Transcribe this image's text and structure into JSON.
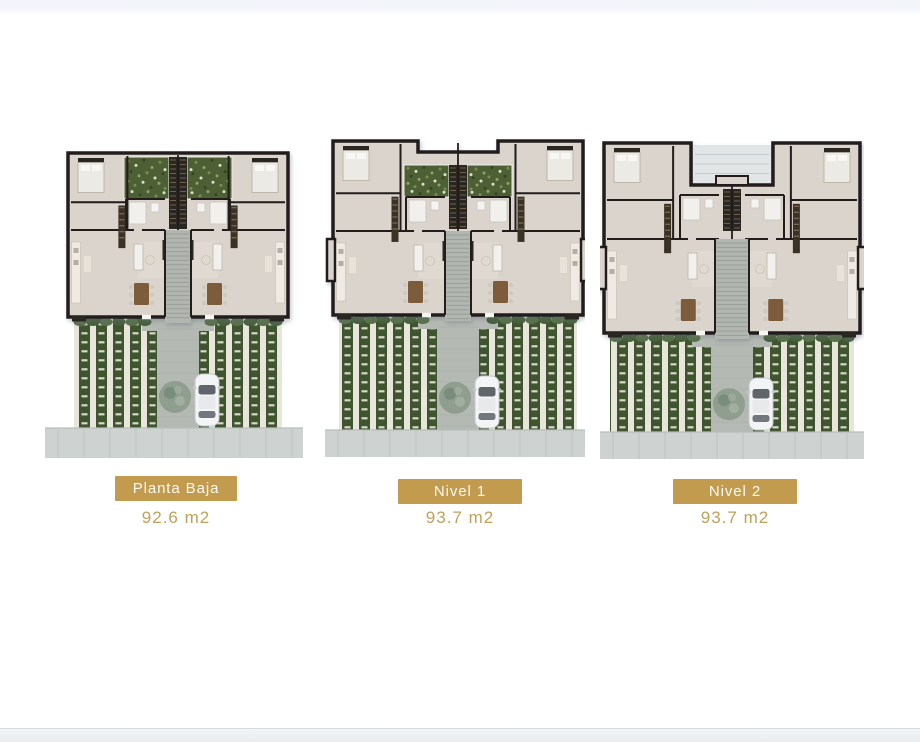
{
  "plans": [
    {
      "name": "Planta Baja",
      "area": "92.6 m2"
    },
    {
      "name": "Nivel 1",
      "area": "93.7 m2"
    },
    {
      "name": "Nivel 2",
      "area": "93.7 m2"
    }
  ],
  "palette": {
    "badge_bg": "#c29b4e",
    "badge_text": "#fdfaf2",
    "area_text": "#c0a159",
    "top_band": "#f4f5fa",
    "bottom_band_light": "#f2f4f6",
    "bottom_band": "#e9edf0",
    "bottom_line": "#d5dade",
    "wall": "#211e1b",
    "floor": "#dbd4cc",
    "floor_light": "#e6e0d9",
    "court_green": "#4d6035",
    "shaft_dark": "#2b2620",
    "wardrobe": "#3a3026",
    "wardrobe_rung": "#816e54",
    "fixture": "#f1f0ed",
    "fixture_edge": "#c6c2bb",
    "table_wood": "#7c5c3a",
    "chair": "#cfc8bd",
    "accent_dark": "#2c2722",
    "stair": "#b2b6b0",
    "stair_line": "#989e98",
    "roof": "#e2e5e6",
    "roof_line": "#c6cccd",
    "lawn": "#3e5530",
    "paver": "#e8e6db",
    "paver_tick": "#d9d7c9",
    "path": "#b4b9b3",
    "path_line": "#a2a8a2",
    "hedge1": "#46603a",
    "hedge2": "#587148",
    "tree": "#8d9c8c",
    "tree_dark": "#76897a",
    "tree_light": "#a6b2a4",
    "sidewalk": "#ced3d2",
    "sidewalk_line": "#b8bebd",
    "car_body": "#f3f4f5",
    "car_edge": "#c4c8cc",
    "car_glass": "#5f656b",
    "car_glass2": "#71777c",
    "car_roof": "#e7e9eb"
  }
}
